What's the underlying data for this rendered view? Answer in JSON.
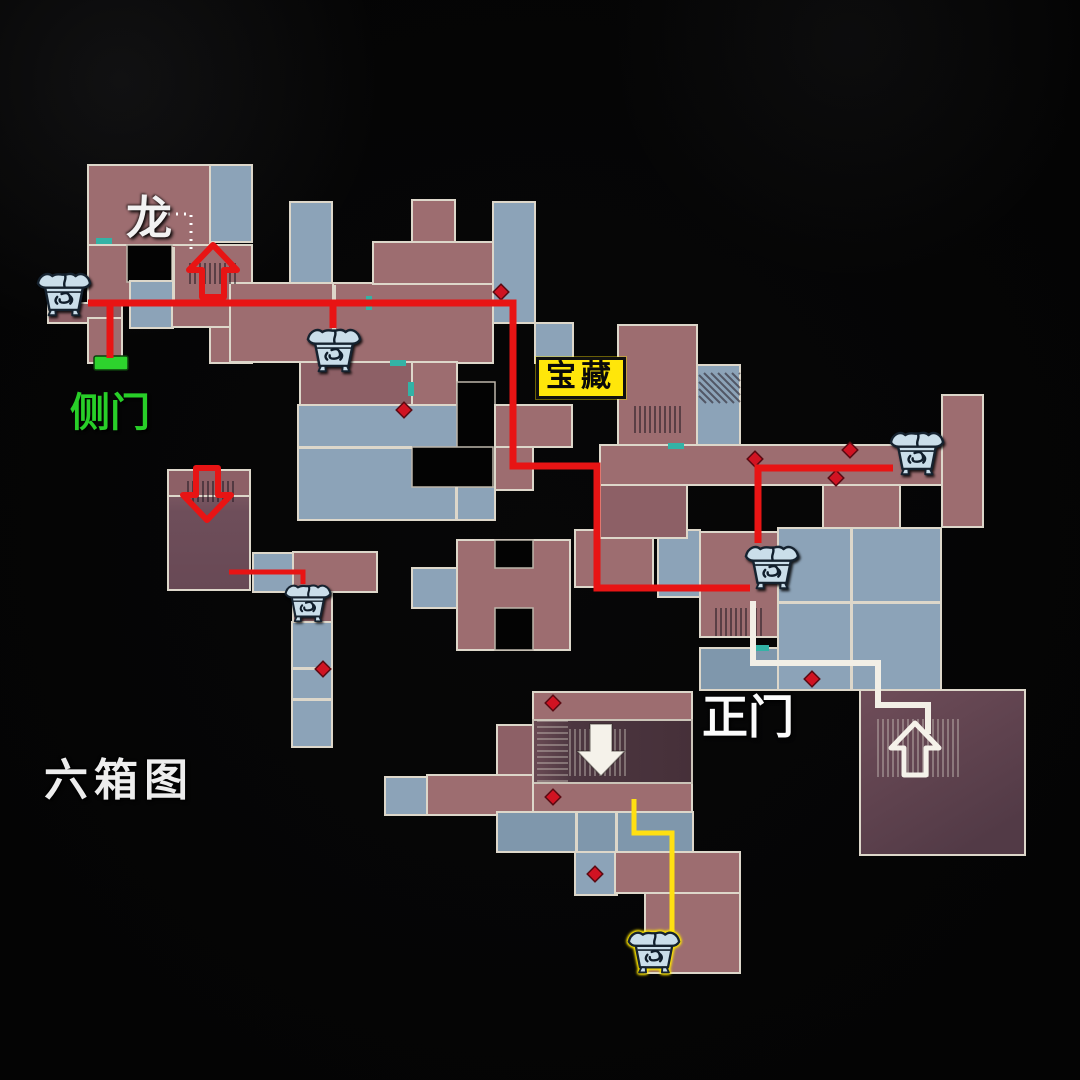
{
  "labels": {
    "dragon": "龙",
    "side_door": "侧门",
    "treasure": "宝藏",
    "main_gate": "正门",
    "map_title": "六箱图"
  },
  "colors": {
    "background": "#040404",
    "room_red": "#9d6d70",
    "room_red_dark": "#8d6066",
    "room_blue": "#8ca3b8",
    "room_blue_dark": "#7f97ac",
    "hole_black": "#030303",
    "wall": "#ddd7ca",
    "path_red": "#e81414",
    "path_white": "#f2efe6",
    "path_yellow": "#ffe012",
    "door_green": "#2dd32d",
    "door_teal": "#33b3a6",
    "marker_red": "#d01322",
    "treasure_bg": "#ffe60a",
    "chest_fill": "#cadeea",
    "chest_ink": "#15222f",
    "glow_yellow": "#ffe600"
  },
  "map": {
    "rooms": [
      {
        "x": 88,
        "y": 165,
        "w": 122,
        "h": 80,
        "shade": "m"
      },
      {
        "x": 210,
        "y": 165,
        "w": 42,
        "h": 77,
        "shade": "b"
      },
      {
        "x": 88,
        "y": 245,
        "w": 164,
        "h": 58,
        "shade": "m"
      },
      {
        "x": 127,
        "y": 245,
        "w": 45,
        "h": 37,
        "shade": "hole"
      },
      {
        "x": 130,
        "y": 281,
        "w": 43,
        "h": 47,
        "shade": "b"
      },
      {
        "x": 48,
        "y": 303,
        "w": 74,
        "h": 20,
        "shade": "m2"
      },
      {
        "x": 88,
        "y": 318,
        "w": 34,
        "h": 45,
        "shade": "m"
      },
      {
        "x": 172,
        "y": 303,
        "w": 80,
        "h": 24,
        "shade": "m"
      },
      {
        "x": 210,
        "y": 327,
        "w": 42,
        "h": 36,
        "shade": "m"
      },
      {
        "x": 290,
        "y": 202,
        "w": 42,
        "h": 81,
        "shade": "b"
      },
      {
        "x": 230,
        "y": 283,
        "w": 103,
        "h": 79,
        "shade": "m"
      },
      {
        "x": 333,
        "y": 283,
        "w": 160,
        "h": 80,
        "shade": "m"
      },
      {
        "x": 412,
        "y": 200,
        "w": 43,
        "h": 43,
        "shade": "m"
      },
      {
        "x": 373,
        "y": 242,
        "w": 120,
        "h": 42,
        "shade": "m"
      },
      {
        "x": 493,
        "y": 202,
        "w": 42,
        "h": 121,
        "shade": "b"
      },
      {
        "x": 535,
        "y": 323,
        "w": 38,
        "h": 40,
        "shade": "b"
      },
      {
        "x": 300,
        "y": 362,
        "w": 112,
        "h": 45,
        "shade": "m2"
      },
      {
        "x": 412,
        "y": 362,
        "w": 45,
        "h": 45,
        "shade": "m"
      },
      {
        "x": 298,
        "y": 405,
        "w": 197,
        "h": 115,
        "shade": "b"
      },
      {
        "x": 457,
        "y": 382,
        "w": 38,
        "h": 105,
        "shade": "hole"
      },
      {
        "x": 412,
        "y": 447,
        "w": 81,
        "h": 40,
        "shade": "hole"
      },
      {
        "x": 495,
        "y": 405,
        "w": 77,
        "h": 42,
        "shade": "m"
      },
      {
        "x": 495,
        "y": 447,
        "w": 38,
        "h": 43,
        "shade": "m"
      },
      {
        "x": 168,
        "y": 470,
        "w": 82,
        "h": 120,
        "shade": "dk1"
      },
      {
        "x": 168,
        "y": 470,
        "w": 82,
        "h": 26,
        "shade": "m2"
      },
      {
        "x": 253,
        "y": 553,
        "w": 40,
        "h": 39,
        "shade": "b"
      },
      {
        "x": 293,
        "y": 552,
        "w": 84,
        "h": 40,
        "shade": "m"
      },
      {
        "x": 293,
        "y": 592,
        "w": 39,
        "h": 30,
        "shade": "m2"
      },
      {
        "x": 292,
        "y": 622,
        "w": 40,
        "h": 125,
        "shade": "b"
      },
      {
        "x": 412,
        "y": 568,
        "w": 45,
        "h": 40,
        "shade": "b"
      },
      {
        "x": 457,
        "y": 540,
        "w": 113,
        "h": 110,
        "shade": "m"
      },
      {
        "x": 495,
        "y": 540,
        "w": 38,
        "h": 28,
        "shade": "hole"
      },
      {
        "x": 495,
        "y": 608,
        "w": 38,
        "h": 42,
        "shade": "hole"
      },
      {
        "x": 575,
        "y": 530,
        "w": 78,
        "h": 57,
        "shade": "m"
      },
      {
        "x": 658,
        "y": 530,
        "w": 42,
        "h": 67,
        "shade": "b"
      },
      {
        "x": 618,
        "y": 325,
        "w": 79,
        "h": 120,
        "shade": "m"
      },
      {
        "x": 697,
        "y": 365,
        "w": 43,
        "h": 120,
        "shade": "b"
      },
      {
        "x": 600,
        "y": 445,
        "w": 343,
        "h": 40,
        "shade": "m"
      },
      {
        "x": 600,
        "y": 485,
        "w": 87,
        "h": 53,
        "shade": "m2"
      },
      {
        "x": 823,
        "y": 485,
        "w": 77,
        "h": 43,
        "shade": "m"
      },
      {
        "x": 942,
        "y": 395,
        "w": 41,
        "h": 132,
        "shade": "m"
      },
      {
        "x": 700,
        "y": 532,
        "w": 78,
        "h": 105,
        "shade": "m"
      },
      {
        "x": 778,
        "y": 528,
        "w": 163,
        "h": 162,
        "shade": "b"
      },
      {
        "x": 700,
        "y": 648,
        "w": 78,
        "h": 42,
        "shade": "b2"
      },
      {
        "x": 860,
        "y": 690,
        "w": 165,
        "h": 165,
        "shade": "dk2"
      },
      {
        "x": 533,
        "y": 692,
        "w": 159,
        "h": 121,
        "shade": "m"
      },
      {
        "x": 533,
        "y": 720,
        "w": 159,
        "h": 63,
        "shade": "dk3"
      },
      {
        "x": 497,
        "y": 725,
        "w": 36,
        "h": 50,
        "shade": "m2"
      },
      {
        "x": 427,
        "y": 775,
        "w": 106,
        "h": 40,
        "shade": "m"
      },
      {
        "x": 385,
        "y": 777,
        "w": 42,
        "h": 38,
        "shade": "b"
      },
      {
        "x": 497,
        "y": 812,
        "w": 196,
        "h": 40,
        "shade": "b2"
      },
      {
        "x": 575,
        "y": 852,
        "w": 42,
        "h": 43,
        "shade": "b"
      },
      {
        "x": 615,
        "y": 852,
        "w": 125,
        "h": 41,
        "shade": "m"
      },
      {
        "x": 645,
        "y": 893,
        "w": 95,
        "h": 80,
        "shade": "m"
      }
    ],
    "walls": [
      {
        "x": 172,
        "y": 247,
        "w": 3,
        "h": 56
      },
      {
        "x": 333,
        "y": 285,
        "w": 3,
        "h": 77
      },
      {
        "x": 298,
        "y": 446,
        "w": 114,
        "h": 3
      },
      {
        "x": 455,
        "y": 487,
        "w": 3,
        "h": 33
      },
      {
        "x": 292,
        "y": 667,
        "w": 40,
        "h": 3
      },
      {
        "x": 292,
        "y": 698,
        "w": 40,
        "h": 3
      },
      {
        "x": 778,
        "y": 601,
        "w": 163,
        "h": 3
      },
      {
        "x": 850,
        "y": 528,
        "w": 3,
        "h": 73
      },
      {
        "x": 850,
        "y": 604,
        "w": 3,
        "h": 86
      },
      {
        "x": 575,
        "y": 813,
        "w": 3,
        "h": 38
      },
      {
        "x": 615,
        "y": 813,
        "w": 3,
        "h": 38
      }
    ],
    "hatches": [
      {
        "x": 190,
        "y": 263,
        "w": 46,
        "h": 21,
        "dir": "v",
        "tone": "d"
      },
      {
        "x": 188,
        "y": 481,
        "w": 48,
        "h": 21,
        "dir": "v",
        "tone": "d"
      },
      {
        "x": 635,
        "y": 406,
        "w": 48,
        "h": 27,
        "dir": "v",
        "tone": "d"
      },
      {
        "x": 716,
        "y": 608,
        "w": 45,
        "h": 28,
        "dir": "v",
        "tone": "d"
      },
      {
        "x": 699,
        "y": 373,
        "w": 41,
        "h": 30,
        "dir": "d",
        "tone": "d"
      },
      {
        "x": 537,
        "y": 721,
        "w": 31,
        "h": 60,
        "dir": "h",
        "tone": "l"
      },
      {
        "x": 570,
        "y": 729,
        "w": 56,
        "h": 47,
        "dir": "v",
        "tone": "l"
      },
      {
        "x": 878,
        "y": 719,
        "w": 82,
        "h": 58,
        "dir": "v",
        "tone": "l"
      }
    ],
    "teal_doors": [
      {
        "x": 96,
        "y": 238,
        "w": 16,
        "h": 6
      },
      {
        "x": 366,
        "y": 296,
        "w": 6,
        "h": 14
      },
      {
        "x": 390,
        "y": 360,
        "w": 16,
        "h": 6
      },
      {
        "x": 408,
        "y": 382,
        "w": 6,
        "h": 14
      },
      {
        "x": 668,
        "y": 443,
        "w": 16,
        "h": 6
      },
      {
        "x": 753,
        "y": 645,
        "w": 16,
        "h": 6
      }
    ],
    "green_door": {
      "x": 94,
      "y": 356,
      "w": 34,
      "h": 14
    },
    "diamond_markers": [
      [
        501,
        292
      ],
      [
        404,
        410
      ],
      [
        755,
        459
      ],
      [
        836,
        478
      ],
      [
        850,
        450
      ],
      [
        323,
        669
      ],
      [
        553,
        703
      ],
      [
        553,
        797
      ],
      [
        595,
        874
      ],
      [
        812,
        679
      ]
    ],
    "paths": [
      {
        "name": "route-red-main",
        "color": "#e81414",
        "width": 7,
        "points": [
          [
            88,
            303
          ],
          [
            513,
            303
          ],
          [
            513,
            466
          ],
          [
            597,
            466
          ],
          [
            597,
            588
          ],
          [
            750,
            588
          ]
        ]
      },
      {
        "name": "route-red-chest4-to-chest5",
        "color": "#e81414",
        "width": 7,
        "points": [
          [
            758,
            543
          ],
          [
            758,
            468
          ],
          [
            893,
            468
          ]
        ]
      },
      {
        "name": "route-red-side-door",
        "color": "#e81414",
        "width": 7,
        "points": [
          [
            110,
            300
          ],
          [
            110,
            358
          ]
        ]
      },
      {
        "name": "route-red-chest2-branch",
        "color": "#e81414",
        "width": 7,
        "points": [
          [
            333,
            300
          ],
          [
            333,
            328
          ]
        ]
      },
      {
        "name": "route-red-chest3-branch",
        "color": "#e81414",
        "width": 5,
        "points": [
          [
            229,
            572
          ],
          [
            303,
            572
          ],
          [
            303,
            584
          ]
        ]
      },
      {
        "name": "route-white",
        "color": "#f2efe6",
        "width": 6,
        "points": [
          [
            753,
            601
          ],
          [
            753,
            663
          ],
          [
            878,
            663
          ],
          [
            878,
            705
          ],
          [
            928,
            705
          ],
          [
            928,
            734
          ]
        ]
      },
      {
        "name": "route-yellow",
        "color": "#ffe012",
        "width": 5,
        "points": [
          [
            634,
            799
          ],
          [
            634,
            833
          ],
          [
            672,
            833
          ],
          [
            672,
            932
          ]
        ]
      },
      {
        "name": "dragon-dotted-trail",
        "color": "#ffffff",
        "width": 3,
        "dash": "2 6",
        "points": [
          [
            168,
            214
          ],
          [
            191,
            214
          ],
          [
            191,
            252
          ]
        ]
      }
    ],
    "arrows": [
      {
        "name": "red-up-arrow",
        "dir": "up",
        "cx": 213,
        "cy": 271,
        "color": "#e81414",
        "style": "hollow",
        "sw": 6
      },
      {
        "name": "red-down-arrow",
        "dir": "down",
        "cx": 207,
        "cy": 494,
        "color": "#e81414",
        "style": "hollow",
        "sw": 6
      },
      {
        "name": "white-down-arrow",
        "dir": "down",
        "cx": 601,
        "cy": 750,
        "color": "#f5f2ea",
        "style": "filled",
        "sw": 1.5
      },
      {
        "name": "white-up-arrow",
        "dir": "up",
        "cx": 915,
        "cy": 749,
        "color": "#f5f2ea",
        "style": "hollow",
        "sw": 5
      }
    ],
    "chests": [
      {
        "x": 64,
        "y": 293,
        "w": 58,
        "glow": false
      },
      {
        "x": 334,
        "y": 349,
        "w": 58,
        "glow": false
      },
      {
        "x": 308,
        "y": 602,
        "w": 50,
        "glow": false
      },
      {
        "x": 772,
        "y": 566,
        "w": 58,
        "glow": false
      },
      {
        "x": 917,
        "y": 452,
        "w": 58,
        "glow": false
      },
      {
        "x": 654,
        "y": 951,
        "w": 56,
        "glow": true
      }
    ]
  }
}
